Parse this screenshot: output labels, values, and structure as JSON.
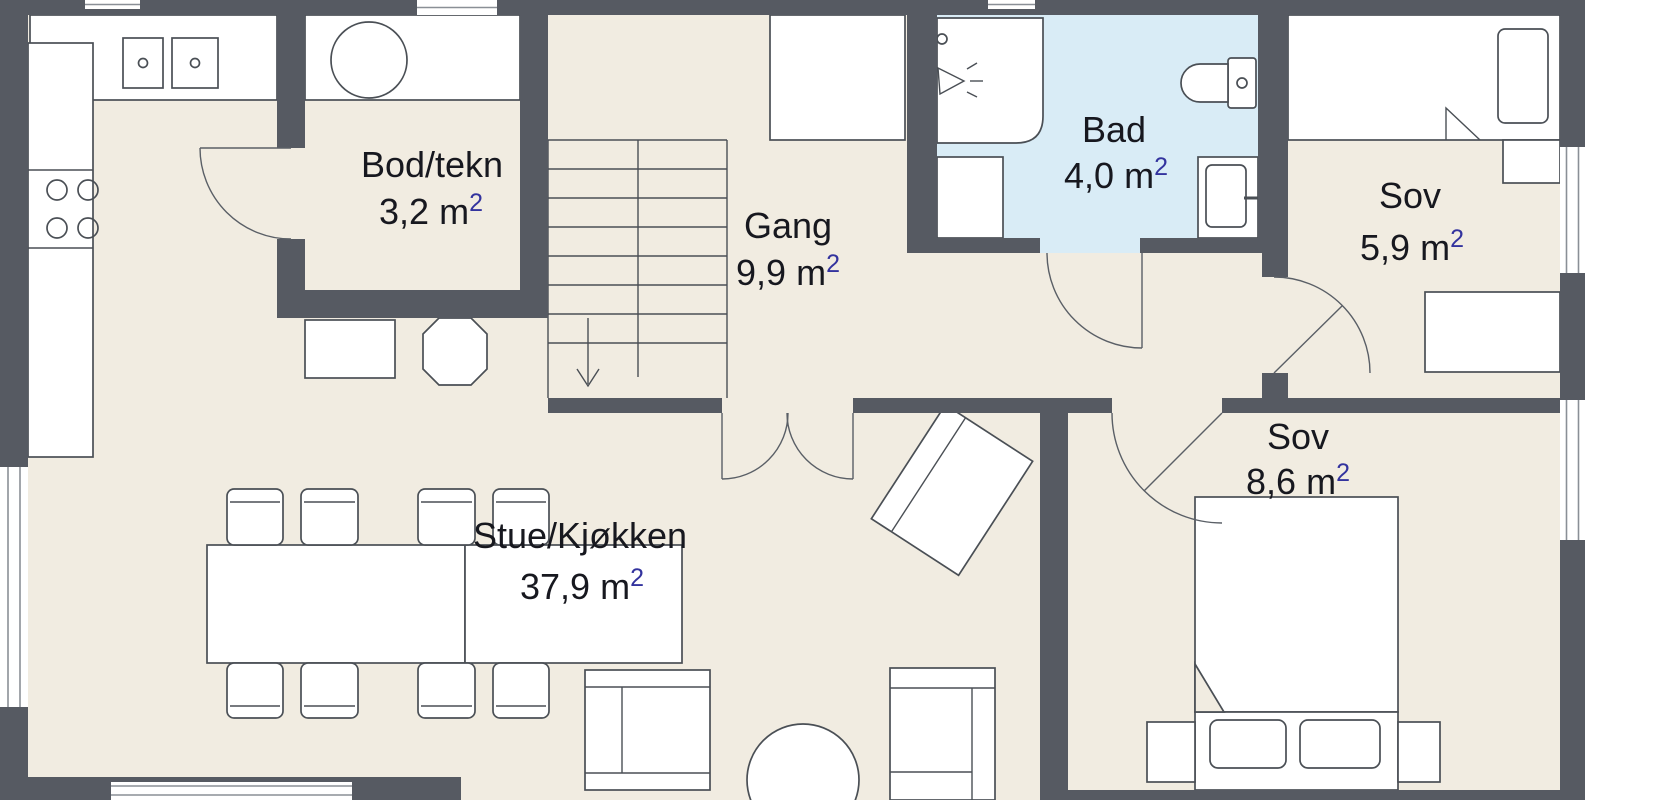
{
  "plan": {
    "type": "floor-plan",
    "rooms": {
      "bod": {
        "name": "Bod/tekn",
        "area": "3,2 m",
        "area_sup": "2"
      },
      "gang": {
        "name": "Gang",
        "area": "9,9 m",
        "area_sup": "2"
      },
      "bad": {
        "name": "Bad",
        "area": "4,0 m",
        "area_sup": "2"
      },
      "sov_small": {
        "name": "Sov",
        "area": "5,9 m",
        "area_sup": "2"
      },
      "sov_large": {
        "name": "Sov",
        "area": "8,6 m",
        "area_sup": "2"
      },
      "stue": {
        "name": "Stue/Kjøkken",
        "area": "37,9 m",
        "area_sup": "2"
      }
    },
    "colors": {
      "wall": "#565a62",
      "floor": "#f1ece1",
      "bathroom_floor": "#d9ecf6",
      "furniture_outline": "#4a4f55",
      "label_text": "#17181f",
      "superscript": "#33339e",
      "background": "#ffffff"
    }
  }
}
